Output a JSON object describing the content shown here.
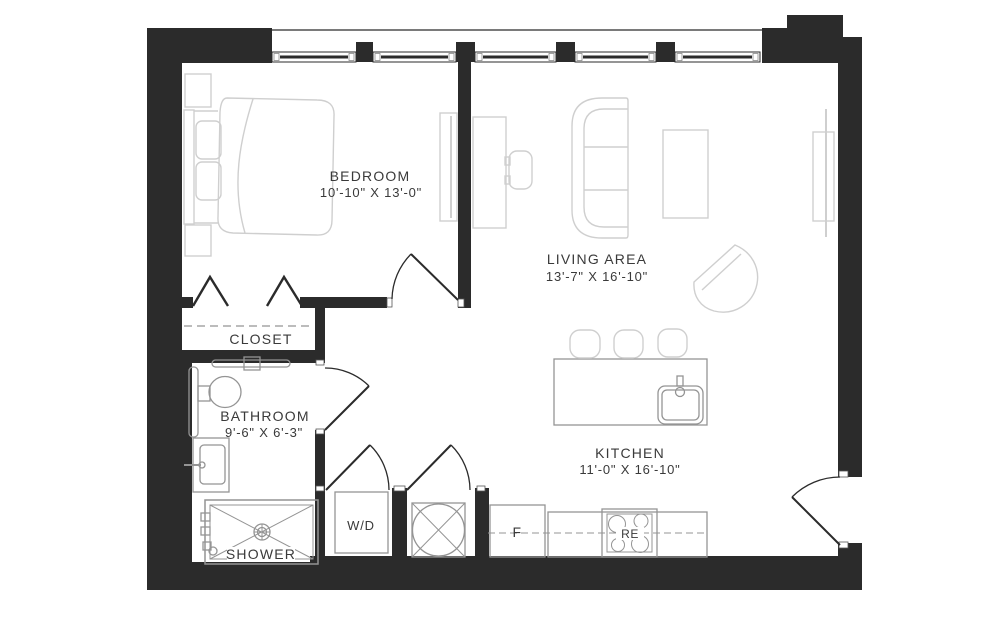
{
  "colors": {
    "background": "#ffffff",
    "wall": "#2b2b2b",
    "door": "#2b2b2b",
    "fixture_line": "#949494",
    "furniture_line": "#cfcfcf",
    "label_text": "#3a3a3a"
  },
  "rooms": {
    "bedroom": {
      "name": "BEDROOM",
      "dims": "10'-10\" X 13'-0\""
    },
    "living": {
      "name": "LIVING AREA",
      "dims": "13'-7\" X 16'-10\""
    },
    "kitchen": {
      "name": "KITCHEN",
      "dims": "11'-0\" X 16'-10\""
    },
    "bathroom": {
      "name": "BATHROOM",
      "dims": "9'-6\" X 6'-3\""
    },
    "closet": {
      "name": "CLOSET"
    },
    "shower": {
      "name": "SHOWER"
    },
    "laundry": {
      "name": "W/D"
    }
  },
  "appliances": {
    "refrigerator": "F",
    "range": "RE"
  }
}
